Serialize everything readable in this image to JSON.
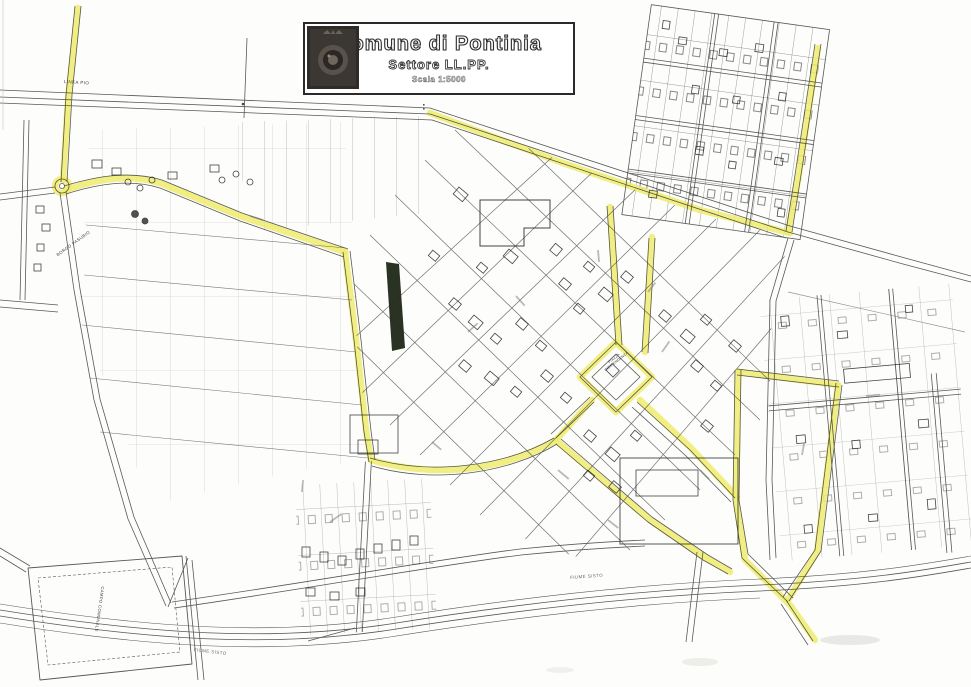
{
  "title_block": {
    "line1": "Comune di Pontinia",
    "line2": "Settore LL.PP.",
    "scale": "Scala 1:5000"
  },
  "map": {
    "labels": [
      {
        "id": "linea-pio",
        "text": "LINEA PIO"
      },
      {
        "id": "borgo-pasubio",
        "text": "BORGO PASUBIO"
      },
      {
        "id": "piazza-indipendenza",
        "text": "PIAZZA INDIPENDENZA"
      },
      {
        "id": "campo-comunale",
        "text": "CAMPO COMUNALE"
      },
      {
        "id": "fiume-sisto-west",
        "text": "FIUME SISTO"
      },
      {
        "id": "fiume-sisto-east",
        "text": "FIUME SISTO"
      }
    ],
    "highlight_color": "#efec6e",
    "line_color": "#2b2b2b",
    "river_name": "Fiume Sisto"
  }
}
